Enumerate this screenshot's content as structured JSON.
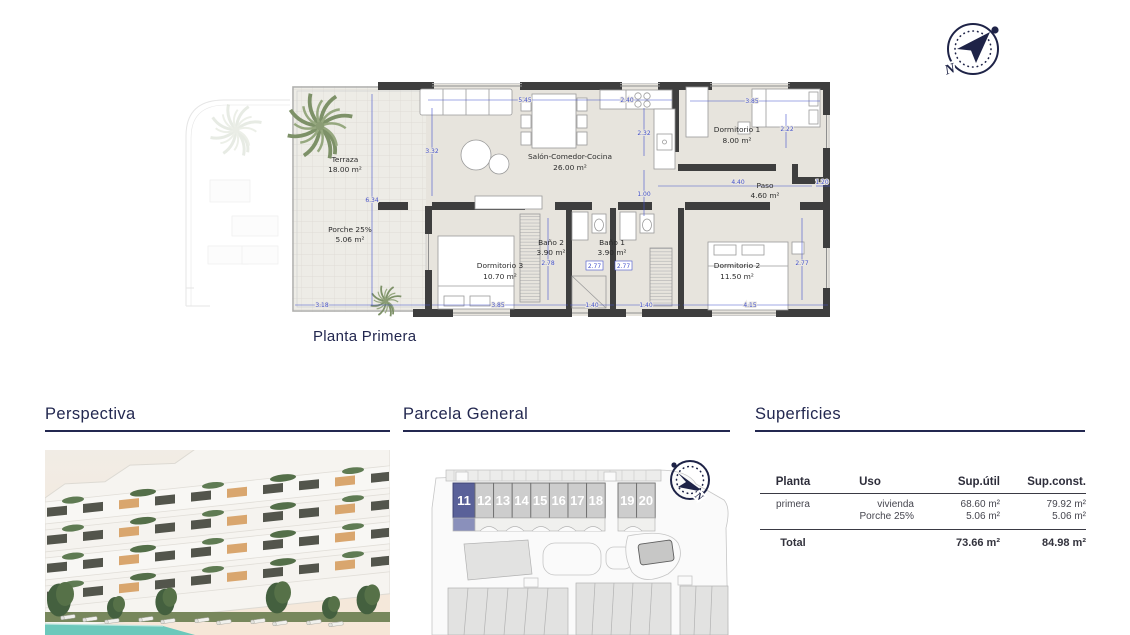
{
  "floorplan": {
    "title": "Planta Primera",
    "rooms": [
      {
        "name": "Terraza",
        "area": "18.00 m²"
      },
      {
        "name": "Porche 25%",
        "area": "5.06 m²"
      },
      {
        "name": "Salón-Comedor-Cocina",
        "area": "26.00 m²"
      },
      {
        "name": "Dormitorio 1",
        "area": "8.00 m²"
      },
      {
        "name": "Paso",
        "area": "4.60 m²"
      },
      {
        "name": "Dormitorio 3",
        "area": "10.70 m²"
      },
      {
        "name": "Baño 2",
        "area": "3.90 m²"
      },
      {
        "name": "Baño 1",
        "area": "3.90 m²"
      },
      {
        "name": "Dormitorio 2",
        "area": "11.50 m²"
      }
    ],
    "dims": {
      "top_living": "5.45",
      "top_kitchen": "2.40",
      "living_height": "3.32",
      "kitchen_height": "2.32",
      "dorm1_top": "3.85",
      "dorm1_right": "2.22",
      "paso_width": "4.40",
      "paso_right": "1.20",
      "hall_width": "1.00",
      "terraza_height": "6.34",
      "terraza_bottom": "3.18",
      "dorm3_bottom": "3.85",
      "dorm3_right": "2.78",
      "bano2_bottom": "1.40",
      "bano1_bottom": "1.40",
      "bano2_door": "2.77",
      "bano1_door": "2.77",
      "dorm2_bottom": "4.15",
      "dorm2_right": "2.77"
    },
    "compass_letter": "N"
  },
  "perspectiva": {
    "title": "Perspectiva"
  },
  "parcela": {
    "title": "Parcela General",
    "units": [
      "11",
      "12",
      "13",
      "14",
      "15",
      "16",
      "17",
      "18",
      "19",
      "20"
    ],
    "highlighted_unit": "11",
    "compass_letter": "N"
  },
  "superficies": {
    "title": "Superficies",
    "headers": [
      "Planta",
      "Uso",
      "Sup.útil",
      "Sup.const."
    ],
    "rows": [
      {
        "planta": "primera",
        "uso": "vivienda",
        "util": "68.60 m²",
        "construida": "79.92 m²"
      },
      {
        "planta": "",
        "uso": "Porche 25%",
        "util": "5.06 m²",
        "construida": "5.06 m²"
      }
    ],
    "total": {
      "label": "Total",
      "util": "73.66 m²",
      "construida": "84.98 m²"
    }
  },
  "colors": {
    "accent_navy": "#232850",
    "dimension_blue": "#4553cc",
    "highlight_unit": "#5a6199",
    "pool_teal": "#6cc8bb"
  }
}
